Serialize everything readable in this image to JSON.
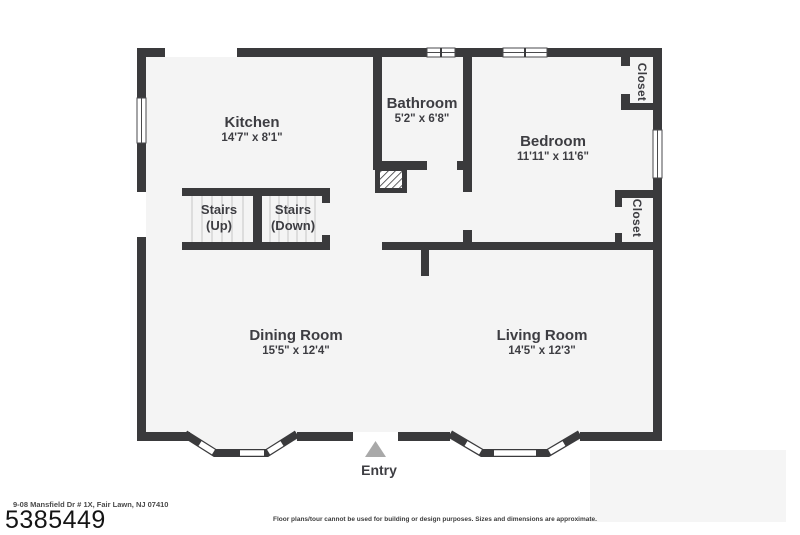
{
  "listing": {
    "id": "5385449",
    "address": "9-08 Mansfield Dr # 1X, Fair Lawn, NJ 07410",
    "disclaimer": "Floor plans/tour cannot be used for building or design purposes. Sizes and dimensions are approximate."
  },
  "floor_plan": {
    "rooms": [
      {
        "name": "Kitchen",
        "dimensions": "14'7\" x 8'1\""
      },
      {
        "name": "Bathroom",
        "dimensions": "5'2\" x 6'8\""
      },
      {
        "name": "Bedroom",
        "dimensions": "11'11\" x 11'6\""
      },
      {
        "name": "Dining Room",
        "dimensions": "15'5\" x 12'4\""
      },
      {
        "name": "Living Room",
        "dimensions": "14'5\" x 12'3\""
      }
    ],
    "stairs": [
      {
        "line1": "Stairs",
        "line2": "(Up)"
      },
      {
        "line1": "Stairs",
        "line2": "(Down)"
      }
    ],
    "closets": [
      {
        "label": "Closet"
      },
      {
        "label": "Closet"
      }
    ],
    "entry_label": "Entry",
    "colors": {
      "wall": "#3a3a3c",
      "floor": "#f4f4f4",
      "tread_line": "#c6c6c6",
      "entry_arrow": "#a9a9a9",
      "label": "#3d3d42"
    }
  }
}
